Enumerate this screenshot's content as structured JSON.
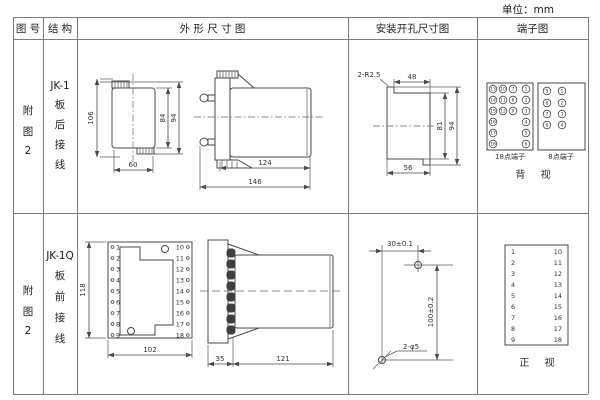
{
  "unit_label": "单位：mm",
  "header": {
    "figure": "图 号",
    "structure": "结 构",
    "outline": "外 形 尺 寸 图",
    "mounting": "安装开孔尺寸图",
    "terminal": "端子图"
  },
  "rows": [
    {
      "figure": [
        "附",
        "图",
        "2"
      ],
      "model": "JK-1",
      "wiring": [
        "板",
        "后",
        "接",
        "线"
      ],
      "outline_dims": {
        "h106": "106",
        "h84": "84",
        "h94": "94",
        "w60": "60",
        "l124": "124",
        "l146": "146"
      },
      "mount_dims": {
        "note": "2-R2.5",
        "w48": "48",
        "h81": "81",
        "h94": "94",
        "w56": "56"
      },
      "terminal": {
        "t18_label": "18点端子",
        "t8_label": "8点端子",
        "view": "背 视",
        "t18_col1": [
          "13",
          "14",
          "15",
          "16",
          "17",
          "18"
        ],
        "t18_col2": [
          "10",
          "11",
          "12"
        ],
        "t18_col3": [
          "7",
          "8",
          "9"
        ],
        "t18_col4": [
          "1",
          "2",
          "3",
          "4",
          "5",
          "6"
        ],
        "t8_left": [
          "5",
          "6",
          "7",
          "8"
        ],
        "t8_right": [
          "1",
          "2",
          "3",
          "4"
        ]
      }
    },
    {
      "figure": [
        "附",
        "图",
        "2"
      ],
      "model": "JK-1Q",
      "wiring": [
        "板",
        "前",
        "接",
        "线"
      ],
      "outline_dims": {
        "h118": "118",
        "w102": "102",
        "d35": "35",
        "l121": "121"
      },
      "mount_dims": {
        "dx": "30±0.1",
        "dy": "100±0.2",
        "note": "2-φ5"
      },
      "pins_left": [
        "1",
        "2",
        "3",
        "4",
        "5",
        "6",
        "7",
        "8",
        "9"
      ],
      "pins_right": [
        "10",
        "11",
        "12",
        "13",
        "14",
        "15",
        "16",
        "17",
        "18"
      ],
      "terminal": {
        "view": "正 视"
      }
    }
  ]
}
